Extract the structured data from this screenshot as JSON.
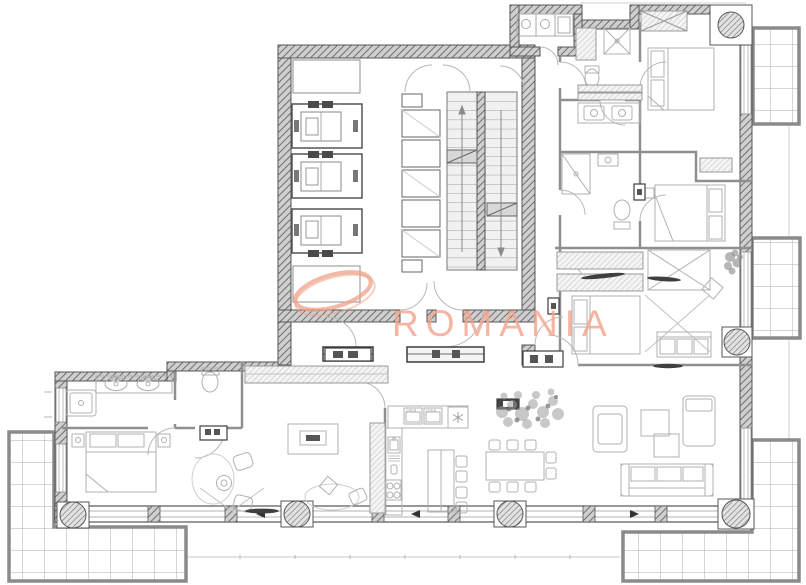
{
  "document": {
    "kind": "architectural floor plan drawing",
    "background": "#ffffff"
  },
  "watermark": {
    "text": "ROMANIA",
    "text_color": "#f4a68e",
    "swoosh_color": "#efa288"
  },
  "kitchen": {
    "appliance_labels": [
      "OVEN",
      "OVEN"
    ]
  },
  "palette": {
    "wall_dark": "#555555",
    "wall_fill": "#cfcfcf",
    "partition": "#8f8f8f",
    "furniture_line": "#b0b0b0",
    "fixture_dark": "#3d3d3d",
    "terrace_wall": "#8a8a8a",
    "terrace_grid": "#adadad",
    "faint_line": "#c9c9c9"
  },
  "plan_stats": {
    "elevators": 3,
    "stair_flights": 2,
    "round_columns": 6,
    "right_side_balconies": 2,
    "ground_terraces": 2,
    "bedrooms": 4
  }
}
